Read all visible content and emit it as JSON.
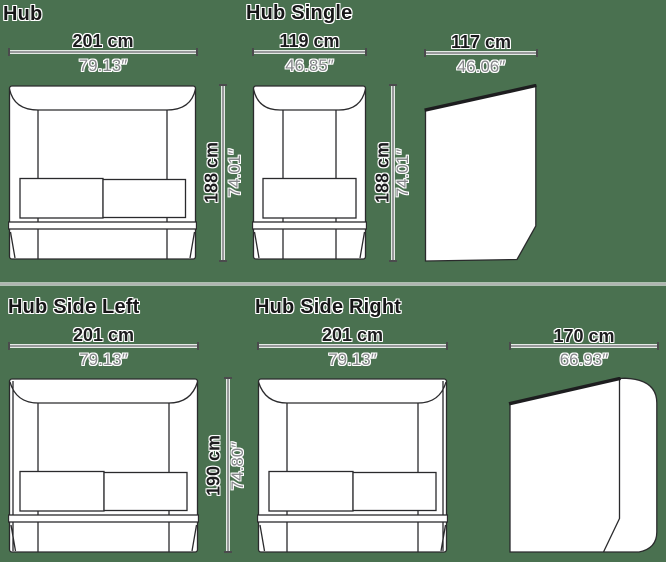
{
  "meta": {
    "background_color": "#4a7150",
    "drawing_line_color": "#2a2a2c",
    "dimension_line_color": "#98999b",
    "cm_text_color": "#1c1c1e",
    "inch_text_color": "#85878a"
  },
  "panels": {
    "hub": {
      "title": "Hub",
      "width_cm": "201 cm",
      "width_in": "79.13″",
      "height_cm": "188 cm",
      "height_in": "74.01″"
    },
    "hub_single": {
      "title": "Hub Single",
      "width_cm": "119 cm",
      "width_in": "46.85″",
      "height_cm": "188 cm",
      "height_in": "74.01″"
    },
    "hub_profile_top": {
      "width_cm": "117 cm",
      "width_in": "46.06″"
    },
    "hub_side_left": {
      "title": "Hub Side Left",
      "width_cm": "201 cm",
      "width_in": "79.13″",
      "height_cm": "190 cm",
      "height_in": "74.80″"
    },
    "hub_side_right": {
      "title": "Hub Side Right",
      "width_cm": "201 cm",
      "width_in": "79.13″"
    },
    "hub_side_profile": {
      "width_cm": "170 cm",
      "width_in": "66.93″"
    }
  }
}
